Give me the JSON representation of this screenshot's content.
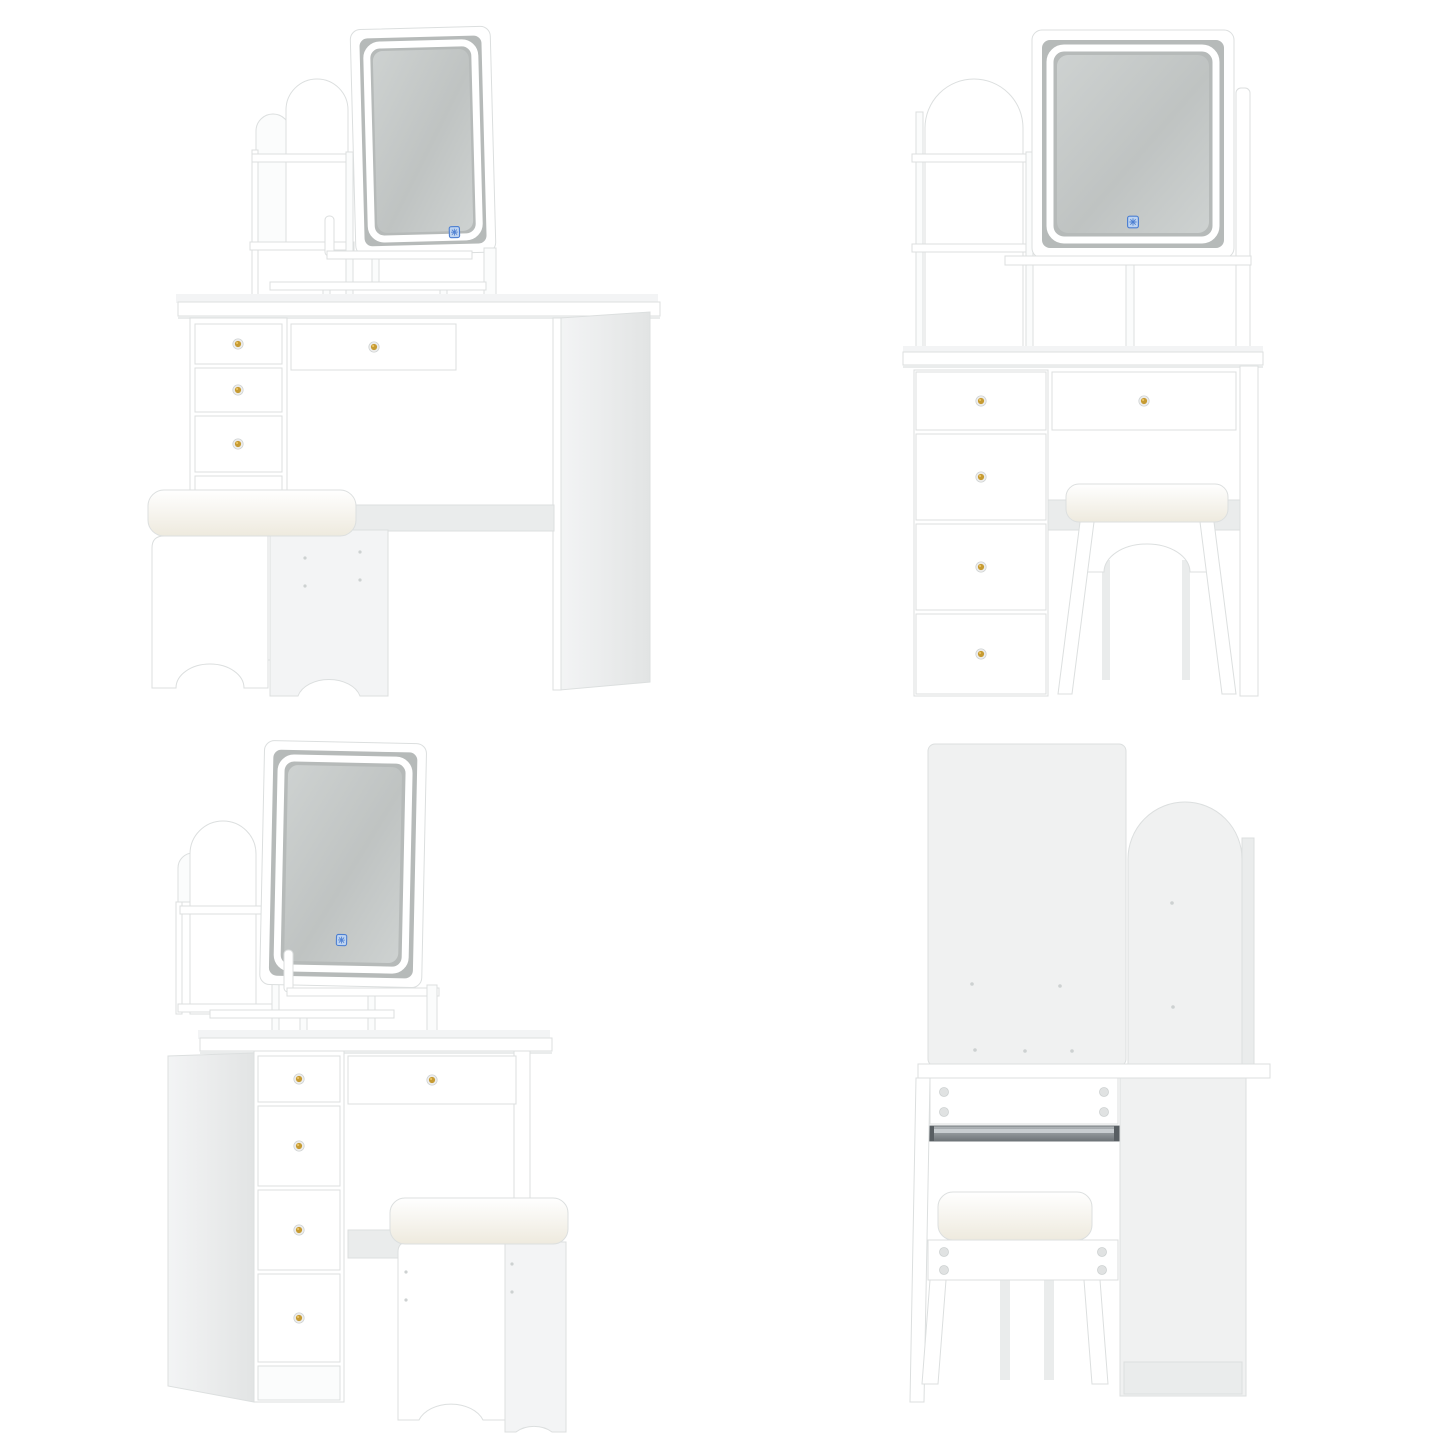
{
  "image": {
    "kind": "product-photo-collage",
    "subject": "White vanity dressing table set with LED-lit mirror, arched storage shelf hutch, five gold-knob drawers and a cushioned stool",
    "text_visible": "",
    "grid": "2x2"
  },
  "views": [
    {
      "id": "front-left-perspective",
      "position": "top-left",
      "elements": [
        "led-mirror",
        "touch-sensor-icon",
        "arched-shelf-hutch",
        "open-shelves",
        "desktop",
        "drawer-column",
        "wide-drawer",
        "knee-space-beam",
        "right-side-panel",
        "cushioned-stool"
      ]
    },
    {
      "id": "front-straight",
      "position": "top-right",
      "elements": [
        "led-mirror",
        "touch-sensor-icon",
        "arched-shelf-hutch",
        "under-mirror-cubbies",
        "desktop",
        "four-drawer-column",
        "wide-drawer",
        "right-leg-panel",
        "cushioned-stool-in-knee-space"
      ]
    },
    {
      "id": "front-right-perspective",
      "position": "bottom-left",
      "elements": [
        "led-mirror",
        "touch-sensor-icon",
        "arched-shelf-hutch",
        "open-shelves",
        "desktop",
        "left-side-panel",
        "four-drawer-column",
        "wide-drawer",
        "knee-space-beam",
        "cushioned-stool"
      ]
    },
    {
      "id": "rear",
      "position": "bottom-right",
      "elements": [
        "large-back-panel",
        "arched-back-panel",
        "side-back-panel",
        "desktop-strip",
        "cam-lock-fittings",
        "metal-drawer-slide",
        "desk-leg",
        "cushioned-stool-rear",
        "cabinet-back-panel"
      ]
    }
  ],
  "hardware": {
    "drawer_knob_style": "round gold knob on silver base plate",
    "touch_control": "blue square touch sensor on mirror glass",
    "drawer_slide": "metal ball-bearing slide rail",
    "fittings": "cam-lock circles on rear panels"
  },
  "colors": {
    "background": "#ffffff",
    "panel_white": "#ffffff",
    "panel_tint": "#fbfcfc",
    "panel_shade_1": "#f3f4f5",
    "panel_shade_2": "#eaecec",
    "panel_shade_3": "#e2e4e4",
    "back_panel": "#f0f1f1",
    "edge_line": "#dcdfdf",
    "edge_strong": "#cdd1d1",
    "glass_margin": "#b6bab9",
    "glass_dark": "#bfc3c2",
    "glass_light": "#ced2d1",
    "led_white": "#ffffff",
    "knob_gold": "#c69b33",
    "knob_gold_hi": "#eec968",
    "knob_base": "#ededed",
    "touch_blue": "#4d7fd1",
    "touch_fill": "#bdd3f0",
    "metal": "#9aa0a4",
    "metal_dark": "#6e7478",
    "cam": "#e0e2e2",
    "cushion_hi": "#ffffff",
    "cushion_lo": "#eeeade"
  }
}
